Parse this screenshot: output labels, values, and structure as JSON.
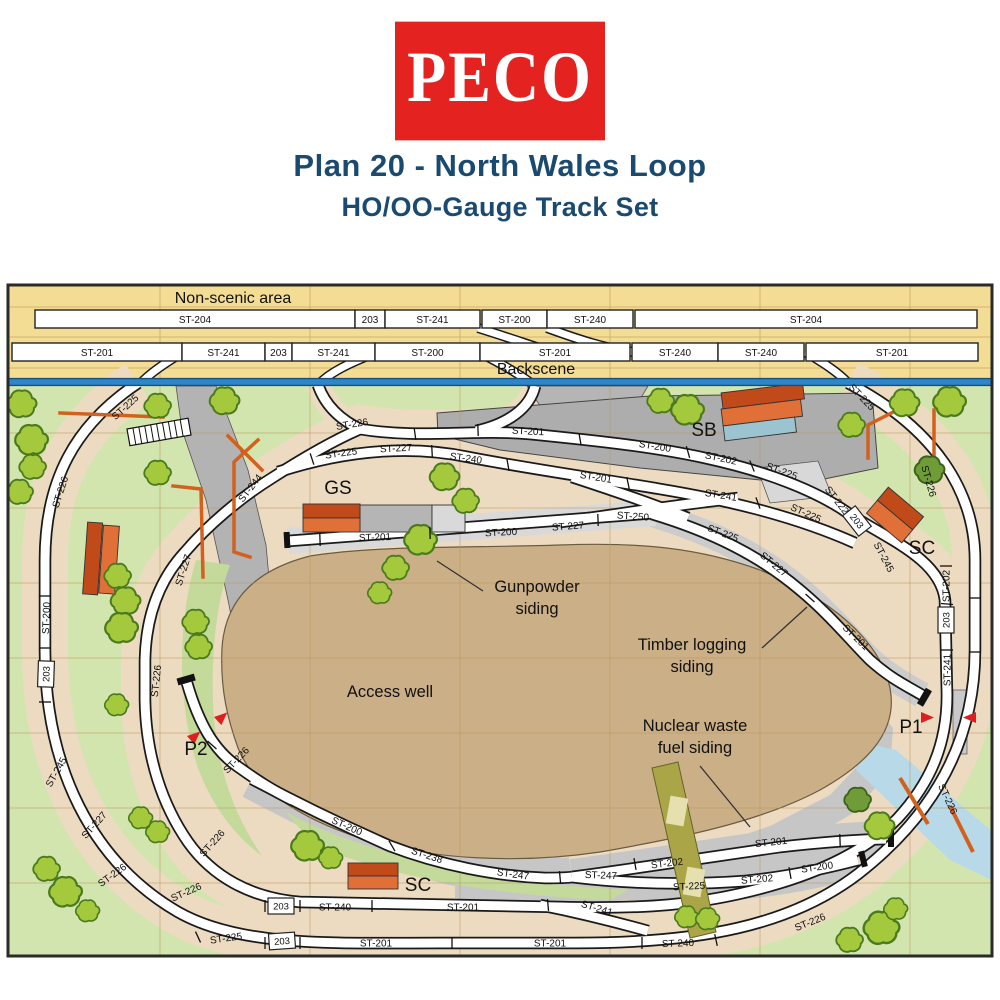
{
  "header": {
    "logo_text": "PECO",
    "title": "Plan 20 - North Wales Loop",
    "subtitle": "HO/OO-Gauge Track Set"
  },
  "colors": {
    "brand_red": "#e42320",
    "title_navy": "#1b4a70",
    "grass_green": "#d3e5ae",
    "board_yellow": "#f3dd94",
    "well_brown": "#cbaf86",
    "backscene_blue": "#2e86c8",
    "marker_red": "#dd1f1f",
    "building_orange": "#e07038"
  },
  "plan": {
    "banners": {
      "non_scenic": {
        "t": "Non-scenic area",
        "x": 233,
        "y": 303
      },
      "backscene": {
        "t": "Backscene",
        "x": 536,
        "y": 374
      }
    },
    "top_rows": [
      {
        "y": 310,
        "segs": [
          {
            "t": "ST-204",
            "x": 35,
            "w": 320
          },
          {
            "t": "203",
            "x": 355,
            "w": 30
          },
          {
            "t": "ST-241",
            "x": 385,
            "w": 95
          },
          {
            "t": "ST-200",
            "x": 482,
            "w": 65
          },
          {
            "t": "ST-240",
            "x": 547,
            "w": 86
          },
          {
            "t": "ST-204",
            "x": 635,
            "w": 342
          }
        ]
      },
      {
        "y": 343,
        "segs": [
          {
            "t": "ST-201",
            "x": 12,
            "w": 170
          },
          {
            "t": "ST-241",
            "x": 182,
            "w": 83
          },
          {
            "t": "203",
            "x": 265,
            "w": 27
          },
          {
            "t": "ST-241",
            "x": 292,
            "w": 83
          },
          {
            "t": "ST-200",
            "x": 375,
            "w": 105
          },
          {
            "t": "ST-201",
            "x": 480,
            "w": 150
          },
          {
            "t": "ST-240",
            "x": 632,
            "w": 86
          },
          {
            "t": "ST-240",
            "x": 718,
            "w": 86
          },
          {
            "t": "ST-201",
            "x": 806,
            "w": 172
          }
        ]
      }
    ],
    "track_labels": [
      {
        "t": "ST-225",
        "x": 125,
        "y": 407,
        "r": -42
      },
      {
        "t": "ST-226",
        "x": 60,
        "y": 492,
        "r": -72
      },
      {
        "t": "ST-200",
        "x": 46,
        "y": 618,
        "r": -88
      },
      {
        "t": "ST-245",
        "x": 56,
        "y": 772,
        "r": -60
      },
      {
        "t": "ST-227",
        "x": 94,
        "y": 825,
        "r": -48
      },
      {
        "t": "ST-226",
        "x": 112,
        "y": 875,
        "r": -36
      },
      {
        "t": "ST-225",
        "x": 226,
        "y": 938,
        "r": -8
      },
      {
        "t": "ST-201",
        "x": 376,
        "y": 943,
        "r": 0
      },
      {
        "t": "ST-201",
        "x": 550,
        "y": 943,
        "r": 0
      },
      {
        "t": "ST-240",
        "x": 678,
        "y": 943,
        "r": -2
      },
      {
        "t": "ST-226",
        "x": 810,
        "y": 922,
        "r": -22
      },
      {
        "t": "ST-226",
        "x": 948,
        "y": 799,
        "r": 65
      },
      {
        "t": "ST-226",
        "x": 929,
        "y": 481,
        "r": 74
      },
      {
        "t": "ST-225",
        "x": 862,
        "y": 397,
        "r": 46
      },
      {
        "t": "ST-226",
        "x": 352,
        "y": 424,
        "r": -9
      },
      {
        "t": "ST-201",
        "x": 528,
        "y": 431,
        "r": 3
      },
      {
        "t": "ST-200",
        "x": 655,
        "y": 446,
        "r": 9
      },
      {
        "t": "ST-202",
        "x": 721,
        "y": 458,
        "r": 12
      },
      {
        "t": "ST-225",
        "x": 782,
        "y": 471,
        "r": 20
      },
      {
        "t": "ST-222",
        "x": 837,
        "y": 500,
        "r": 52
      },
      {
        "t": "ST-245",
        "x": 884,
        "y": 557,
        "r": 62
      },
      {
        "t": "ST-202",
        "x": 946,
        "y": 586,
        "r": -90
      },
      {
        "t": "ST-241",
        "x": 947,
        "y": 670,
        "r": -90
      },
      {
        "t": "ST-225",
        "x": 341,
        "y": 453,
        "r": -8
      },
      {
        "t": "ST-227",
        "x": 396,
        "y": 448,
        "r": -3
      },
      {
        "t": "ST-240",
        "x": 466,
        "y": 458,
        "r": 8
      },
      {
        "t": "ST-201",
        "x": 596,
        "y": 477,
        "r": 9
      },
      {
        "t": "ST-241",
        "x": 721,
        "y": 495,
        "r": 9
      },
      {
        "t": "ST-225",
        "x": 806,
        "y": 513,
        "r": 24
      },
      {
        "t": "ST-250",
        "x": 633,
        "y": 516,
        "r": 4
      },
      {
        "t": "ST-225",
        "x": 723,
        "y": 533,
        "r": 21
      },
      {
        "t": "ST-227",
        "x": 774,
        "y": 564,
        "r": 40
      },
      {
        "t": "ST-201",
        "x": 856,
        "y": 637,
        "r": 44
      },
      {
        "t": "ST-244",
        "x": 250,
        "y": 488,
        "r": -52
      },
      {
        "t": "ST-227",
        "x": 183,
        "y": 570,
        "r": -72
      },
      {
        "t": "ST-226",
        "x": 156,
        "y": 681,
        "r": -84
      },
      {
        "t": "ST-226",
        "x": 236,
        "y": 760,
        "r": -46
      },
      {
        "t": "ST-226",
        "x": 212,
        "y": 843,
        "r": -48
      },
      {
        "t": "ST-226",
        "x": 186,
        "y": 892,
        "r": -24
      },
      {
        "t": "ST-201",
        "x": 375,
        "y": 537,
        "r": -2
      },
      {
        "t": "ST-200",
        "x": 501,
        "y": 532,
        "r": -3
      },
      {
        "t": "ST-227",
        "x": 568,
        "y": 526,
        "r": -4
      },
      {
        "t": "ST-200",
        "x": 347,
        "y": 826,
        "r": 24
      },
      {
        "t": "ST-238",
        "x": 427,
        "y": 855,
        "r": 18
      },
      {
        "t": "ST-247",
        "x": 513,
        "y": 874,
        "r": 8
      },
      {
        "t": "ST-247",
        "x": 601,
        "y": 875,
        "r": 2
      },
      {
        "t": "ST-202",
        "x": 667,
        "y": 863,
        "r": -7
      },
      {
        "t": "ST-201",
        "x": 771,
        "y": 842,
        "r": -6
      },
      {
        "t": "ST-225",
        "x": 689,
        "y": 886,
        "r": -3
      },
      {
        "t": "ST-202",
        "x": 757,
        "y": 879,
        "r": -5
      },
      {
        "t": "ST-200",
        "x": 817,
        "y": 867,
        "r": -8
      },
      {
        "t": "ST-241",
        "x": 597,
        "y": 908,
        "r": 17
      },
      {
        "t": "ST-240",
        "x": 335,
        "y": 907,
        "r": 0
      },
      {
        "t": "ST-201",
        "x": 463,
        "y": 907,
        "r": 0
      }
    ],
    "boxed_labels": [
      {
        "t": "203",
        "x": 46,
        "y": 674,
        "r": -88
      },
      {
        "t": "203",
        "x": 857,
        "y": 521,
        "r": 52
      },
      {
        "t": "203",
        "x": 946,
        "y": 620,
        "r": -90
      },
      {
        "t": "203",
        "x": 281,
        "y": 906,
        "r": 0
      },
      {
        "t": "203",
        "x": 282,
        "y": 941,
        "r": -4
      }
    ],
    "poi_labels": [
      {
        "t": "SB",
        "x": 704,
        "y": 436
      },
      {
        "t": "GS",
        "x": 338,
        "y": 494
      },
      {
        "t": "SC",
        "x": 922,
        "y": 554
      },
      {
        "t": "SC",
        "x": 418,
        "y": 891
      },
      {
        "t": "P1",
        "x": 911,
        "y": 733
      },
      {
        "t": "P2",
        "x": 196,
        "y": 755
      }
    ],
    "notes": [
      {
        "lines": [
          "Gunpowder",
          "siding"
        ],
        "x": 537,
        "y": 592,
        "leader": [
          483,
          591,
          437,
          561
        ]
      },
      {
        "lines": [
          "Timber logging",
          "siding"
        ],
        "x": 692,
        "y": 650,
        "leader": [
          762,
          648,
          807,
          607
        ]
      },
      {
        "lines": [
          "Access well"
        ],
        "x": 390,
        "y": 697
      },
      {
        "lines": [
          "Nuclear waste",
          "fuel siding"
        ],
        "x": 695,
        "y": 731,
        "leader": [
          700,
          766,
          750,
          827
        ]
      }
    ],
    "ticks": [
      [
        45,
        596,
        0
      ],
      [
        45,
        648,
        0
      ],
      [
        45,
        702,
        0
      ],
      [
        198,
        937,
        65
      ],
      [
        265,
        943,
        90
      ],
      [
        300,
        943,
        90
      ],
      [
        452,
        943,
        90
      ],
      [
        642,
        943,
        90
      ],
      [
        716,
        940,
        78
      ],
      [
        265,
        906,
        90
      ],
      [
        300,
        906,
        90
      ],
      [
        372,
        906,
        90
      ],
      [
        548,
        905,
        85
      ],
      [
        946,
        566,
        0
      ],
      [
        947,
        604,
        5
      ],
      [
        947,
        650,
        0
      ],
      [
        975,
        598,
        0
      ],
      [
        975,
        652,
        0
      ],
      [
        415,
        434,
        82
      ],
      [
        478,
        430,
        88
      ],
      [
        580,
        439,
        80
      ],
      [
        688,
        452,
        74
      ],
      [
        752,
        466,
        68
      ],
      [
        312,
        459,
        72
      ],
      [
        432,
        451,
        87
      ],
      [
        508,
        465,
        80
      ],
      [
        628,
        483,
        78
      ],
      [
        758,
        503,
        70
      ],
      [
        320,
        540,
        88
      ],
      [
        430,
        533,
        88
      ],
      [
        598,
        520,
        88
      ],
      [
        560,
        877,
        85
      ],
      [
        392,
        846,
        60
      ],
      [
        635,
        864,
        80
      ],
      [
        790,
        873,
        80
      ],
      [
        840,
        840,
        88
      ],
      [
        810,
        598,
        42
      ],
      [
        212,
        745,
        42
      ]
    ]
  }
}
